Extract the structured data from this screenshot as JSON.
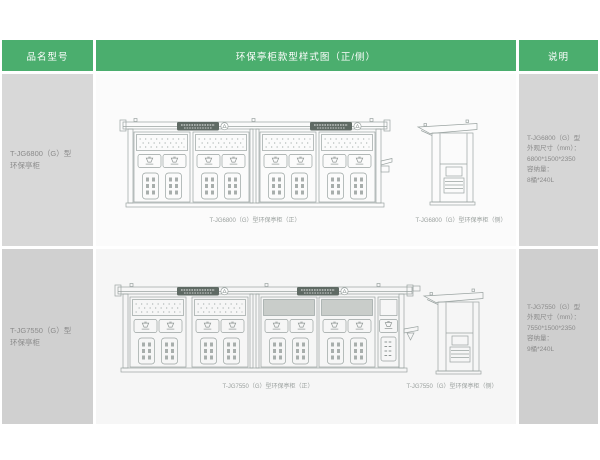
{
  "colors": {
    "accent_green": "#4bae6e",
    "cell_gray": "#d8d8d8",
    "line_gray": "#9aa3a1"
  },
  "header": {
    "col_model": "品名型号",
    "col_diagram": "环保亭柜款型样式图（正/侧）",
    "col_desc": "说明"
  },
  "rows": [
    {
      "model_line1": "T-JG6800（G）型",
      "model_line2": "环保亭柜",
      "caption_front": "T-JG6800（G）型环保亭柜（正）",
      "caption_side": "T-JG6800（G）型环保亭柜（侧）",
      "spec": [
        "T-JG6800（G）型",
        "外观尺寸（mm）：",
        "6800*1500*2350",
        "容纳量：",
        "8桶*240L"
      ]
    },
    {
      "model_line1": "T-JG7550（G）型",
      "model_line2": "环保亭柜",
      "caption_front": "T-JG7550（G）型环保亭柜（正）",
      "caption_side": "T-JG7550（G）型环保亭柜（侧）",
      "spec": [
        "T-JG7550（G）型",
        "外观尺寸（mm）：",
        "7550*1500*2350",
        "容纳量：",
        "9桶*240L"
      ]
    }
  ]
}
